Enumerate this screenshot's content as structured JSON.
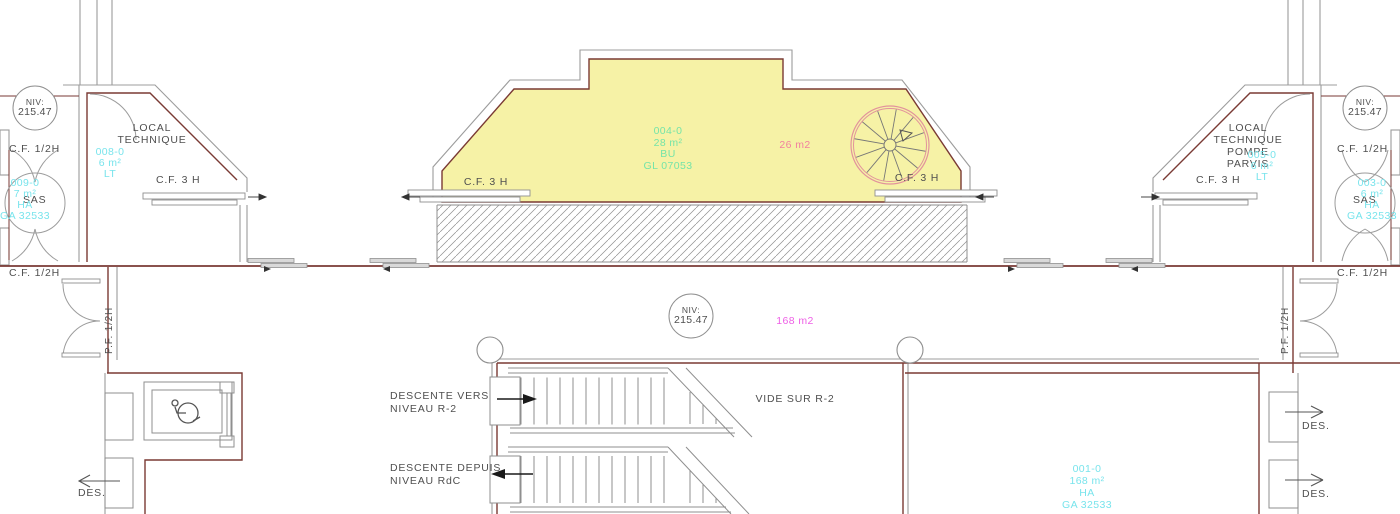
{
  "colors": {
    "wall_dark": "#7a3a34",
    "wall_gray": "#9c9c9c",
    "room_fill": "#f6f2a6",
    "tag_cyan": "#79e4ec",
    "tag_green": "#74e4a8",
    "area_pink": "#f2809f",
    "area_magenta": "#ee5ee6",
    "stair_pink": "#e2939c",
    "text_dark": "#4f4f4f"
  },
  "niv": {
    "label": "NIV:",
    "value": "215.47"
  },
  "left": {
    "cf_half_top": "C.F. 1/2H",
    "cf_half_bottom": "C.F. 1/2H",
    "sas": "SAS",
    "sas_tag": {
      "id": "009-0",
      "area": "7 m²",
      "type": "HA",
      "code": "GA 32533"
    },
    "room_line1": "LOCAL",
    "room_line2": "TECHNIQUE",
    "room_tag": {
      "id": "008-0",
      "area": "6 m²",
      "type": "LT"
    },
    "cf3": "C.F. 3 H",
    "pf": "P.F. 1/2H",
    "des": "DES."
  },
  "center_top": {
    "tag": {
      "id": "004-0",
      "area": "28 m²",
      "type": "BU",
      "code": "GL 07053"
    },
    "area_note": "26 m2",
    "cf3_left": "C.F. 3 H",
    "cf3_right": "C.F. 3 H"
  },
  "right": {
    "cf_half_top": "C.F. 1/2H",
    "cf_half_bottom": "C.F. 1/2H",
    "sas": "SAS",
    "sas_tag": {
      "id": "003-0",
      "area": "6 m²",
      "type": "HA",
      "code": "GA 32533"
    },
    "room_line1": "LOCAL",
    "room_line2": "TECHNIQUE",
    "room_line3": "POMPE",
    "room_line4": "PARVIS",
    "room_tag": {
      "id": "005-0",
      "area": "6 m²",
      "type": "LT"
    },
    "cf3": "C.F. 3 H",
    "pf": "P.F. 1/2H",
    "des1": "DES.",
    "des2": "DES."
  },
  "center_bottom": {
    "area_note": "168 m2",
    "vide": "VIDE SUR R-2",
    "stair_down_line1": "DESCENTE VERS",
    "stair_down_line2": "NIVEAU R-2",
    "stair_from_line1": "DESCENTE DEPUIS",
    "stair_from_line2": "NIVEAU RdC",
    "tag": {
      "id": "001-0",
      "area": "168 m²",
      "type": "HA",
      "code": "GA 32533"
    }
  }
}
